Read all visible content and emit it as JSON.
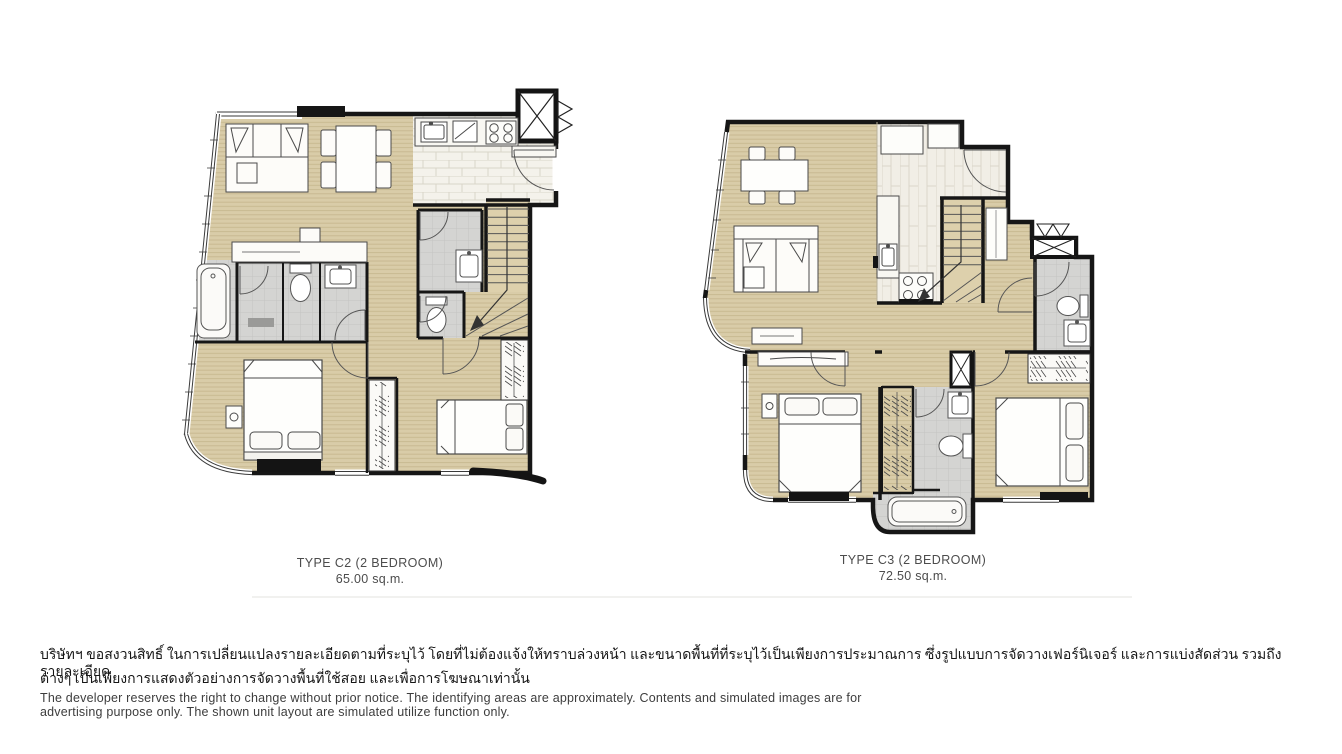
{
  "plans": [
    {
      "id": "C2",
      "title": "TYPE C2  (2 BEDROOM)",
      "area": "65.00 sq.m."
    },
    {
      "id": "C3",
      "title": "TYPE C3  (2 BEDROOM)",
      "area": "72.50 sq.m."
    }
  ],
  "disclaimer": {
    "thai_line1": "บริษัทฯ ขอสงวนสิทธิ์ ในการเปลี่ยนแปลงรายละเอียดตามที่ระบุไว้ โดยที่ไม่ต้องแจ้งให้ทราบล่วงหน้า และขนาดพื้นที่ที่ระบุไว้เป็นเพียงการประมาณการ ซึ่งรูปแบบการจัดวางเฟอร์นิเจอร์ และการแบ่งสัดส่วน รวมถึงรายละเอียด",
    "thai_line2": "ต่างๆ เป็นเพียงการแสดงตัวอย่างการจัดวางพื้นที่ใช้สอย และเพื่อการโฆษณาเท่านั้น",
    "english_line1": "The developer reserves the right to change without prior notice. The identifying areas are approximately. Contents and simulated images are for",
    "english_line2": "advertising purpose only. The shown unit layout are simulated utilize function only."
  },
  "colors": {
    "wood_floor": "#d9cca8",
    "wood_stripe": "#c7b78f",
    "kitchen_tile": "#f4f2eb",
    "bath_tile": "#d4d4d2",
    "wall": "#161616",
    "caption_text": "#4c4c4c",
    "background": "#ffffff"
  }
}
